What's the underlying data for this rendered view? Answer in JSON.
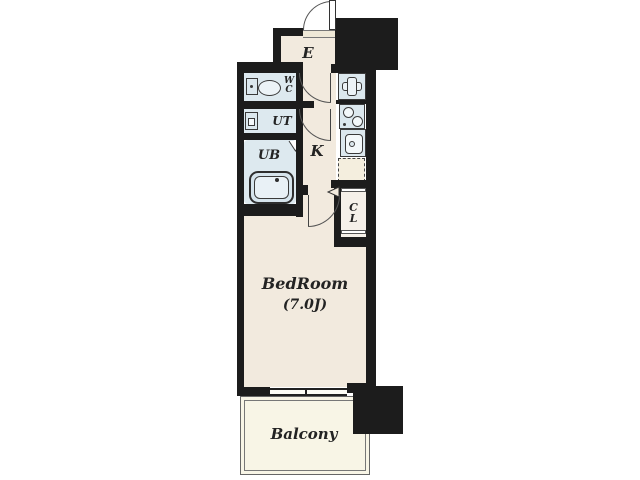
{
  "plan": {
    "type": "apartment-floor-plan",
    "rooms": {
      "entrance": {
        "label": "E"
      },
      "wc": {
        "label_line1": "W",
        "label_line2": "C"
      },
      "utility": {
        "label": "UT"
      },
      "unit_bath": {
        "label": "UB"
      },
      "kitchen": {
        "label": "K"
      },
      "closet": {
        "label_line1": "C",
        "label_line2": "L"
      },
      "bedroom": {
        "label": "BedRoom",
        "size": "(7.0J)"
      },
      "balcony": {
        "label": "Balcony"
      }
    },
    "colors": {
      "wall": "#1c1c1c",
      "floor": "#f2eade",
      "wet_area": "#dde9ef",
      "fixture": "#ecf3f7",
      "closet": "#f5f0e9",
      "balcony": "#f8f5e6",
      "line": "#3a3a3a"
    }
  }
}
